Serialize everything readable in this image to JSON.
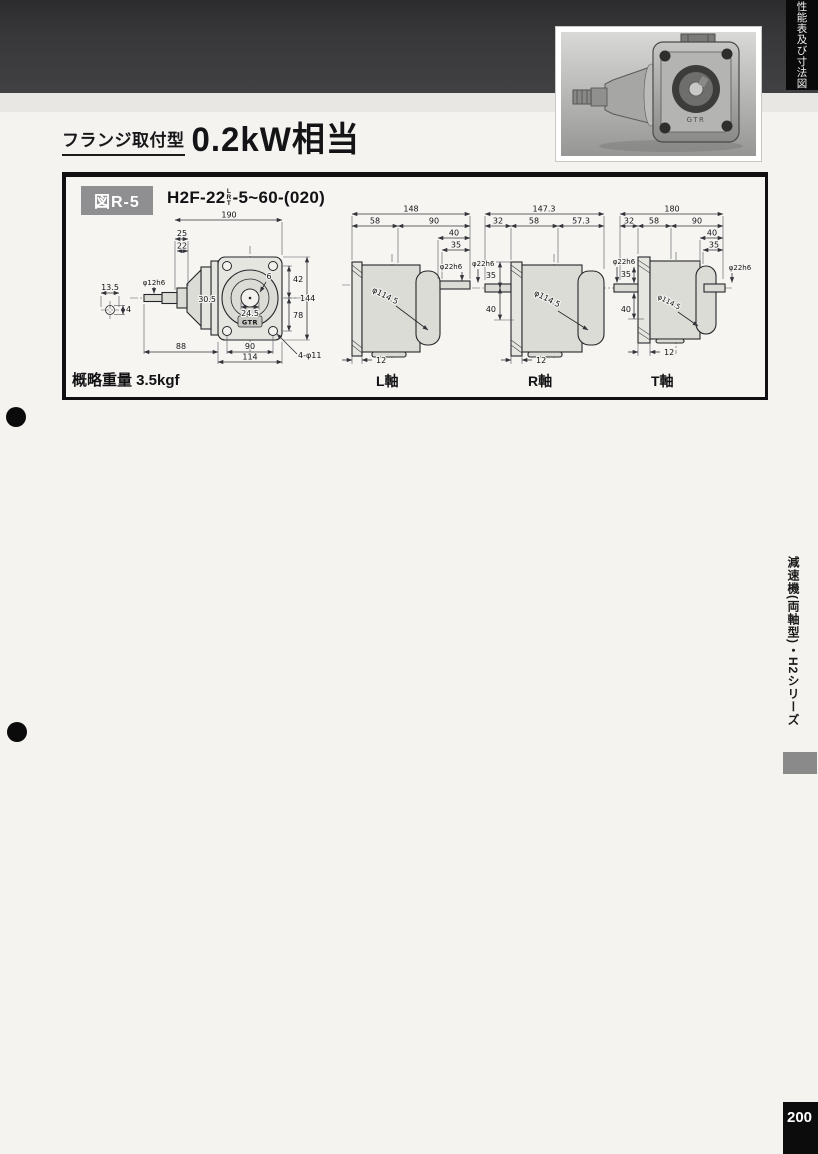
{
  "page": {
    "top_tab_text": "性能表及び寸法図",
    "side_tab_text": "減速機(両軸型)・H2シリーズ",
    "page_number": "200"
  },
  "header": {
    "type_label": "フランジ取付型",
    "title": "0.2kW相当"
  },
  "figure": {
    "fig_no": "図R-5",
    "model_prefix": "H2F-22",
    "model_axis_top": "L",
    "model_axis_mid": "R",
    "model_axis_bot": "T",
    "model_suffix": "-5~60-(020)",
    "weight": "概略重量 3.5kgf",
    "logo": "GTR"
  },
  "views": {
    "front": {
      "dims": {
        "overall_w": "190",
        "step1": "25",
        "step2": "22",
        "key_w": "13.5",
        "key_h": "4",
        "shaft_dia": "φ12h6",
        "offset": "30.5",
        "hole_c": "24.5",
        "small": "6",
        "top_c": "42",
        "bot_c": "78",
        "height": "144",
        "left_w": "88",
        "hole_sp": "90",
        "flange_w": "114",
        "holes": "4-φ11"
      }
    },
    "l_axis": {
      "label": "L軸",
      "dims": {
        "overall": "148",
        "body": "58",
        "right": "90",
        "d40": "40",
        "d35": "35",
        "shaft": "φ22h6",
        "flange_dia": "φ114.5",
        "flange_t": "12"
      }
    },
    "r_axis": {
      "label": "R軸",
      "dims": {
        "overall": "147.3",
        "left": "32",
        "body": "58",
        "right": "57.3",
        "shaft": "φ22h6",
        "d35": "35",
        "d40": "40",
        "flange_dia": "φ114.5",
        "flange_t": "12"
      }
    },
    "t_axis": {
      "label": "T軸",
      "dims": {
        "overall": "180",
        "left": "32",
        "body": "58",
        "right": "90",
        "d40": "40",
        "d35": "35",
        "shaft_l": "φ22h6",
        "l35": "35",
        "l40": "40",
        "shaft_r": "φ22h6",
        "flange_dia": "φ114.5",
        "flange_t": "12"
      }
    }
  }
}
